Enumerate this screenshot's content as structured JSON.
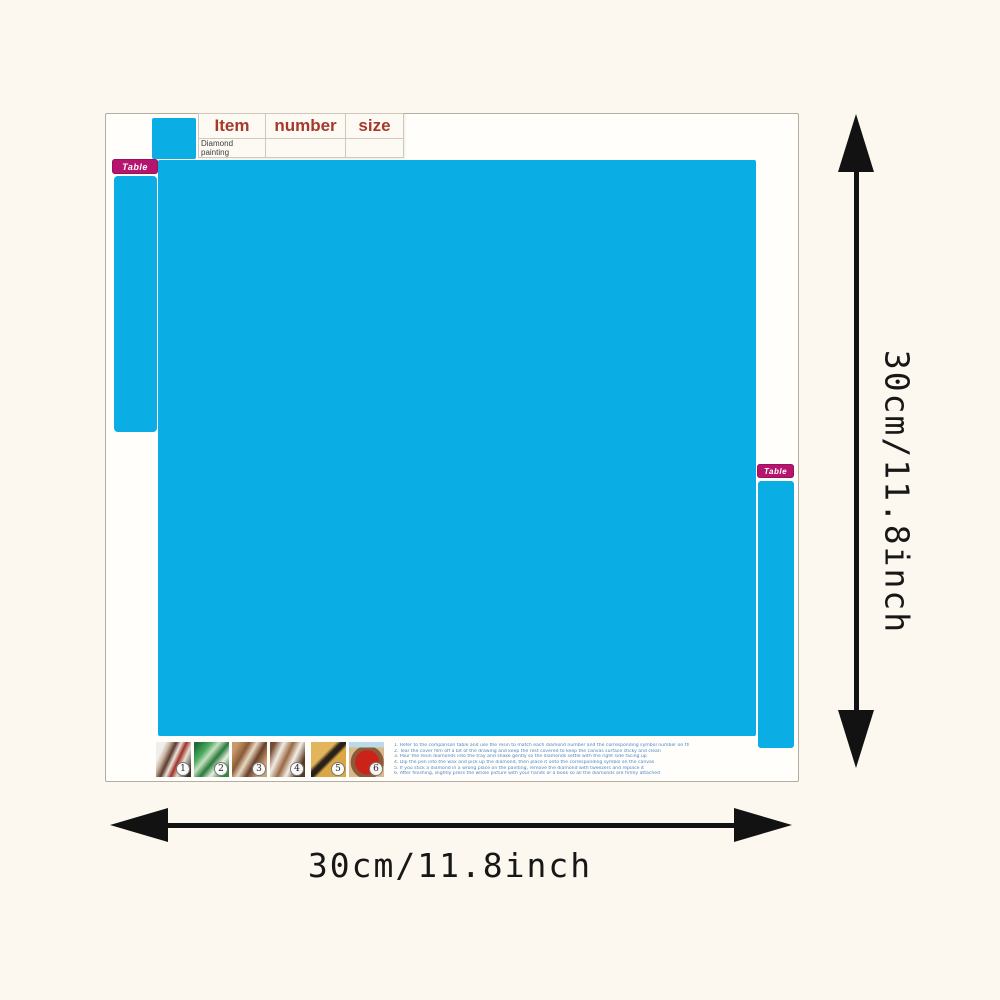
{
  "spec_table": {
    "header_columns": [
      "Item",
      "number",
      "size"
    ],
    "item_name": "Diamond painting"
  },
  "tabs": {
    "left_label": "Table",
    "right_label": "Table",
    "tag_color": "#b5156e"
  },
  "canvas": {
    "color": "#0aade4"
  },
  "dimensions": {
    "width_label": "30cm/11.8inch",
    "height_label": "30cm/11.8inch"
  },
  "steps": [
    {
      "number": "1"
    },
    {
      "number": "2"
    },
    {
      "number": "3"
    },
    {
      "number": "4"
    },
    {
      "number": "5"
    },
    {
      "number": "6"
    }
  ],
  "instructions": [
    "1. Refer to the comparison table and use the resin to match each diamond number and the corresponding symbol number on the canvas",
    "2. Tear the cover film off a bit of the drawing and keep the rest covered to keep the canvas surface sticky and clean",
    "3. Pour the resin diamonds into the tray and shake gently so the diamonds settle with the right side facing up",
    "4. Dip the pen into the wax and pick up the diamond, then place it onto the corresponding symbol on the canvas",
    "5. If you stick a diamond in a wrong place on the painting, remove the diamond with tweezers and replace it",
    "6. After finishing, slightly press the whole picture with your hands or a book so all the diamonds are firmly attached"
  ]
}
